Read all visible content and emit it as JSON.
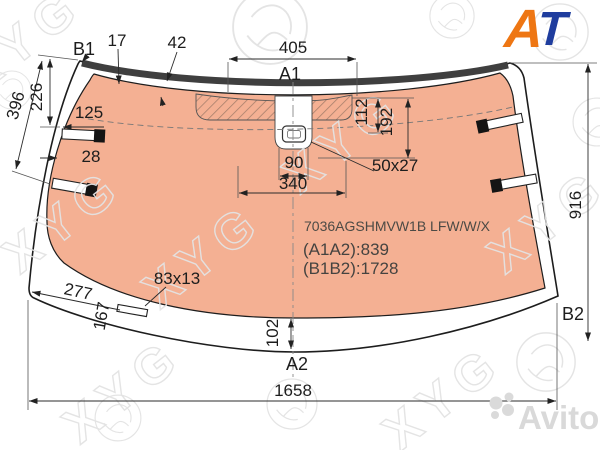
{
  "diagram": {
    "part_number": "7036AGSHMVW1B LFW/W/X",
    "dim_summary_a": "(A1A2):839",
    "dim_summary_b": "(B1B2):1728"
  },
  "ref_points": {
    "b1": "B1",
    "a1": "A1",
    "a2": "A2",
    "b2": "B2"
  },
  "dims": {
    "d17": "17",
    "d42": "42",
    "d405": "405",
    "d226": "226",
    "d396": "396",
    "d125": "125",
    "d28": "28",
    "d90": "90",
    "d340": "340",
    "d50x27": "50x27",
    "d112": "112",
    "d192": "192",
    "d916": "916",
    "d277": "277",
    "d167": "167",
    "d83x13": "83x13",
    "d102": "102",
    "d1658": "1658"
  },
  "watermarks": {
    "brand": "XYG",
    "site": "Avito"
  },
  "logo": {
    "a": "A",
    "t": "T"
  },
  "colors": {
    "glass": "#f4b093",
    "molding": "#3f3f3f",
    "hatch_line": "#a8806c",
    "line": "#2b2b2b",
    "watermark": "#e3e3e3",
    "logo_orange": "#ee7613",
    "logo_blue": "#1f3d9e"
  }
}
